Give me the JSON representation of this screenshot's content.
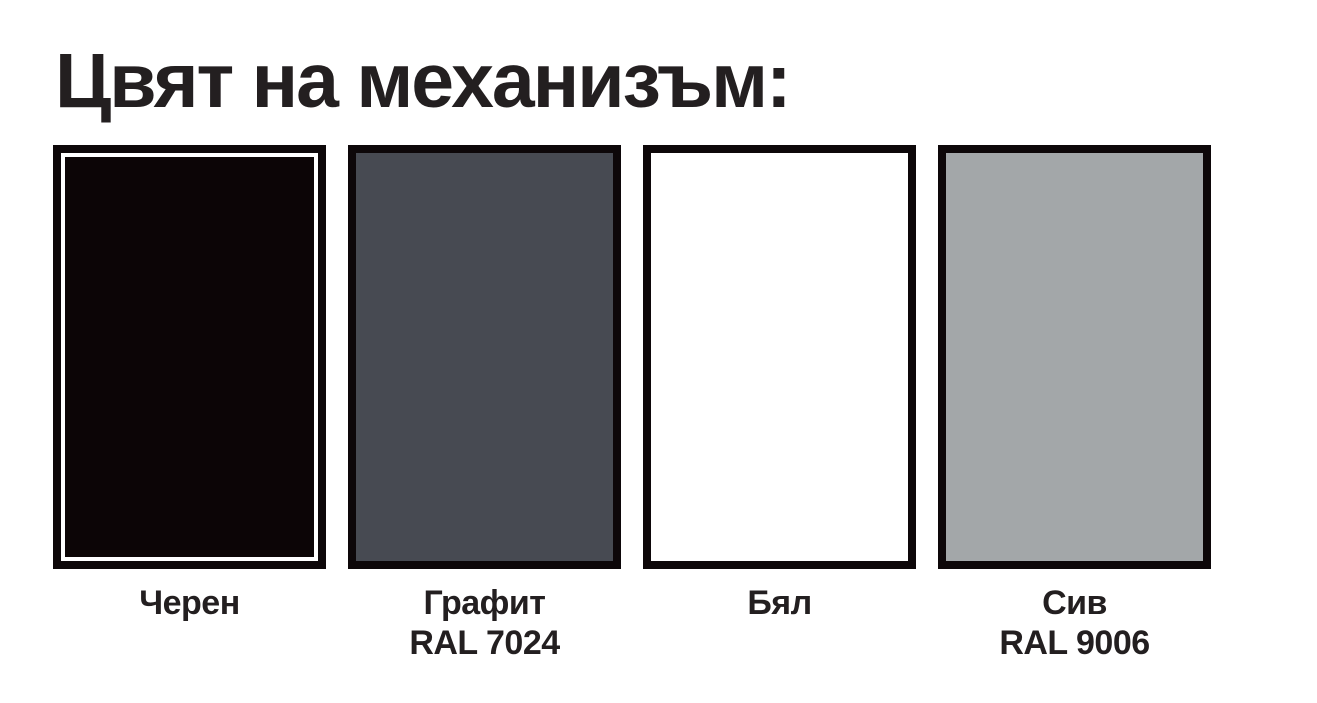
{
  "title": "Цвят на механизъм:",
  "colors": {
    "background": "#ffffff",
    "text": "#231f20",
    "swatch_border": "#0d0709",
    "black_swatch_inner_stroke": "#ffffff"
  },
  "swatches": [
    {
      "id": "black",
      "label_line1": "Черен",
      "label_line2": "",
      "fill": "#0c0506"
    },
    {
      "id": "graphite",
      "label_line1": "Графит",
      "label_line2": "RAL 7024",
      "fill": "#474a52"
    },
    {
      "id": "white",
      "label_line1": "Бял",
      "label_line2": "",
      "fill": "#ffffff"
    },
    {
      "id": "gray",
      "label_line1": "Сив",
      "label_line2": "RAL 9006",
      "fill": "#a3a7a9"
    }
  ]
}
